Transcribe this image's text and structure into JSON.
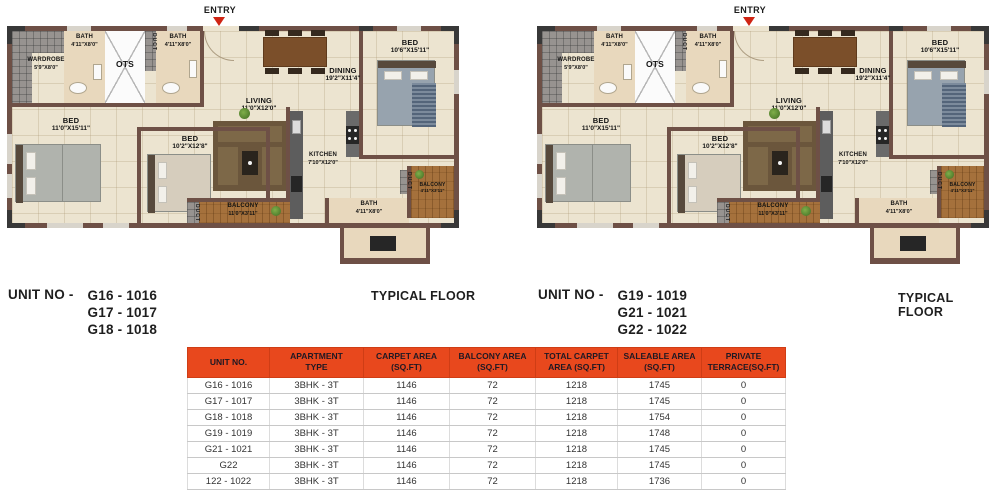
{
  "sheet": {
    "plans": [
      {
        "unit_prefix": "UNIT NO  -",
        "units": [
          "G16 - 1016",
          "G17 - 1017",
          "G18 - 1018"
        ],
        "typical": "TYPICAL FLOOR"
      },
      {
        "unit_prefix": "UNIT NO -",
        "units": [
          "G19 - 1019",
          "G21 - 1021",
          "G22 - 1022"
        ],
        "typical": "TYPICAL FLOOR"
      }
    ]
  },
  "floorplan": {
    "entry_label": "ENTRY",
    "rooms": {
      "wardrobe": {
        "name": "WARDROBE",
        "dim": "5'9\"X8'0\""
      },
      "bath_top_left": {
        "name": "BATH",
        "dim": "4'11\"X8'0\""
      },
      "ots": {
        "name": "OTS"
      },
      "duct": {
        "name": "DUCT"
      },
      "bath_top_right": {
        "name": "BATH",
        "dim": "4'11\"X8'0\""
      },
      "dining": {
        "name": "DINING",
        "dim": "19'2\"X11'4\""
      },
      "bed_top_right": {
        "name": "BED",
        "dim": "10'6\"X15'11\""
      },
      "living": {
        "name": "LIVING",
        "dim": "11'0\"X12'0\""
      },
      "bed_left": {
        "name": "BED",
        "dim": "11'0\"X15'11\""
      },
      "bed_middle": {
        "name": "BED",
        "dim": "10'2\"X12'8\""
      },
      "kitchen": {
        "name": "KITCHEN",
        "dim": "7'10\"X12'0\""
      },
      "balcony_bottom": {
        "name": "BALCONY",
        "dim": "11'0\"X3'11\""
      },
      "bath_bottom": {
        "name": "BATH",
        "dim": "4'11\"X8'0\""
      },
      "balcony_right": {
        "name": "BALCONY",
        "dim": "4'11\"X3'11\""
      }
    }
  },
  "table": {
    "headers": [
      [
        "UNIT NO."
      ],
      [
        "APARTMENT",
        "TYPE"
      ],
      [
        "CARPET AREA",
        "(SQ.FT)"
      ],
      [
        "BALCONY AREA",
        "(SQ.FT)"
      ],
      [
        "TOTAL CARPET",
        "AREA (SQ.FT)"
      ],
      [
        "SALEABLE AREA",
        "(SQ.FT)"
      ],
      [
        "PRIVATE",
        "TERRACE(SQ.FT)"
      ]
    ],
    "rows": [
      [
        "G16 - 1016",
        "3BHK - 3T",
        "1146",
        "72",
        "1218",
        "1745",
        "0"
      ],
      [
        "G17 - 1017",
        "3BHK - 3T",
        "1146",
        "72",
        "1218",
        "1745",
        "0"
      ],
      [
        "G18 - 1018",
        "3BHK - 3T",
        "1146",
        "72",
        "1218",
        "1754",
        "0"
      ],
      [
        "G19 - 1019",
        "3BHK - 3T",
        "1146",
        "72",
        "1218",
        "1748",
        "0"
      ],
      [
        "G21 - 1021",
        "3BHK - 3T",
        "1146",
        "72",
        "1218",
        "1745",
        "0"
      ],
      [
        "G22",
        "3BHK - 3T",
        "1146",
        "72",
        "1218",
        "1745",
        "0"
      ],
      [
        "122 - 1022",
        "3BHK - 3T",
        "1146",
        "72",
        "1218",
        "1736",
        "0"
      ]
    ]
  },
  "colors": {
    "table_header": "#e8481d",
    "wall": "#6e5046",
    "entry_arrow": "#cf2413",
    "balcony_wood": "#a5713c",
    "floor": "#ece4d0"
  }
}
